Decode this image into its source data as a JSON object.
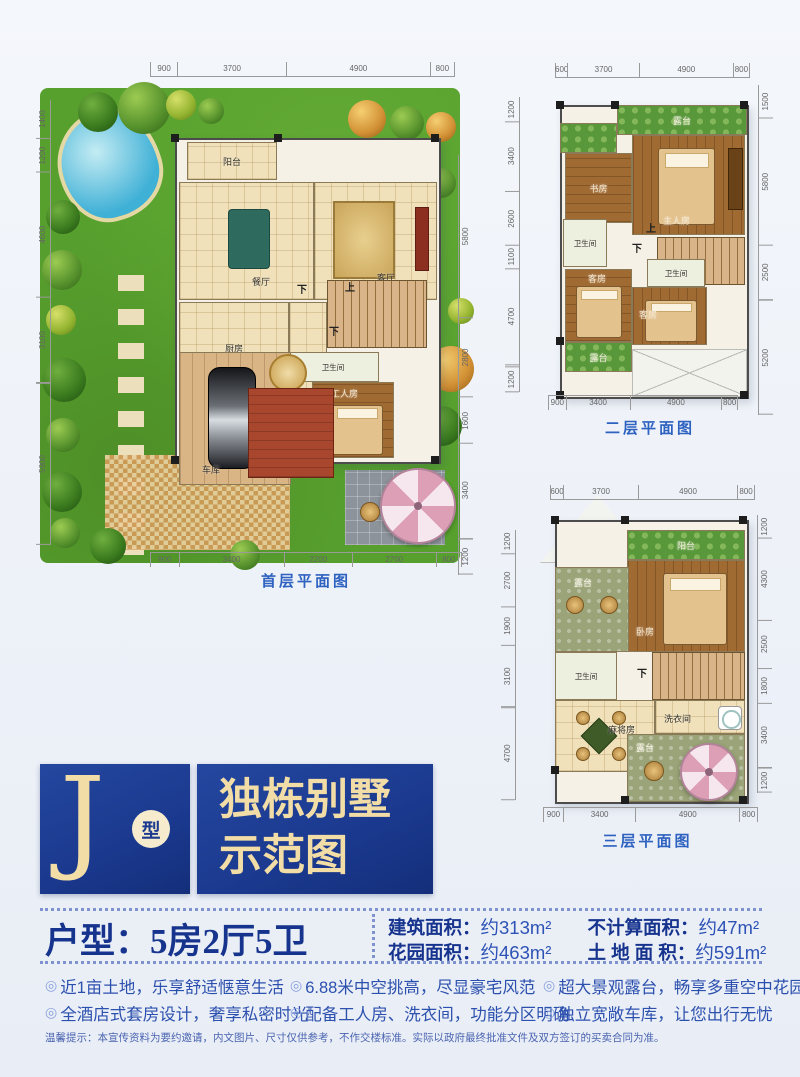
{
  "colors": {
    "brand_blue": "#1b3a90",
    "gold": "#f2dda6",
    "text_blue": "#2d52b5",
    "caption_blue": "#2e62c0",
    "garden_green": "#57a02e"
  },
  "plans": {
    "first": {
      "caption": "首层平面图",
      "rooms": {
        "balcony": "阳台",
        "living": "客厅",
        "dining": "餐厅",
        "kitchen": "厨房",
        "bath": "卫生间",
        "worker": "工人房",
        "garage": "车库",
        "stair_down": "下",
        "stair_up": "上",
        "stair_down2": "下"
      },
      "dims": {
        "top": [
          "900",
          "3700",
          "4900",
          "800"
        ],
        "bottom": [
          "900",
          "3400",
          "2200",
          "2700",
          "800"
        ],
        "left": [
          "1400",
          "1200",
          "4600",
          "3100",
          "5900"
        ],
        "right": [
          "5800",
          "2800",
          "1600",
          "3400",
          "1200"
        ]
      }
    },
    "second": {
      "caption": "二层平面图",
      "rooms": {
        "terrace_top": "露台",
        "study": "书房",
        "master": "主人房",
        "bath1": "卫生间",
        "bath2": "卫生间",
        "guest1": "客房",
        "guest2": "客房",
        "terrace_bottom": "露台",
        "stair_up": "上",
        "stair_down": "下"
      },
      "dims": {
        "top": [
          "600",
          "3700",
          "4900",
          "800"
        ],
        "bottom": [
          "900",
          "3400",
          "4900",
          "800"
        ],
        "left": [
          "1200",
          "3400",
          "2600",
          "1100",
          "4700",
          "1200"
        ],
        "right": [
          "1500",
          "5800",
          "2500",
          "5200"
        ]
      }
    },
    "third": {
      "caption": "三层平面图",
      "rooms": {
        "balcony": "阳台",
        "terrace_upper": "露台",
        "bedroom": "卧房",
        "bath": "卫生间",
        "mahjong": "麻将房",
        "laundry": "洗衣间",
        "terrace_lower": "露台",
        "stair_down": "下"
      },
      "dims": {
        "top": [
          "600",
          "3700",
          "4900",
          "800"
        ],
        "bottom": [
          "900",
          "3400",
          "4900",
          "800"
        ],
        "left": [
          "1200",
          "2700",
          "1900",
          "3100",
          "4700"
        ],
        "right": [
          "1200",
          "4300",
          "2500",
          "1800",
          "3400",
          "1200"
        ]
      }
    }
  },
  "brand": {
    "letter": "J",
    "circle_label": "型",
    "title_line1": "独栋别墅",
    "title_line2": "示范图"
  },
  "info": {
    "layout_title": "户型：5房2厅5卫",
    "stats": [
      {
        "label": "建筑面积：",
        "value": "约313m²"
      },
      {
        "label": "花园面积：",
        "value": "约463m²"
      },
      {
        "label": "不计算面积：",
        "value": "约47m²"
      },
      {
        "label": "土 地 面 积：",
        "value": "约591m²"
      }
    ]
  },
  "features": {
    "bullet": "◎",
    "items": [
      {
        "text": "近1亩土地，乐享舒适惬意生活"
      },
      {
        "text": "全酒店式套房设计，奢享私密时光"
      },
      {
        "text": "6.88米中空挑高，尽显豪宅风范"
      },
      {
        "text": "配备工人房、洗衣间，功能分区明确"
      },
      {
        "text": "超大景观露台，畅享多重空中花园"
      },
      {
        "text": "独立宽敞车库，让您出行无忧"
      }
    ]
  },
  "disclaimer": "温馨提示：本宣传资料为要约邀请，内文图片、尺寸仅供参考，不作交楼标准。实际以政府最终批准文件及双方签订的买卖合同为准。"
}
